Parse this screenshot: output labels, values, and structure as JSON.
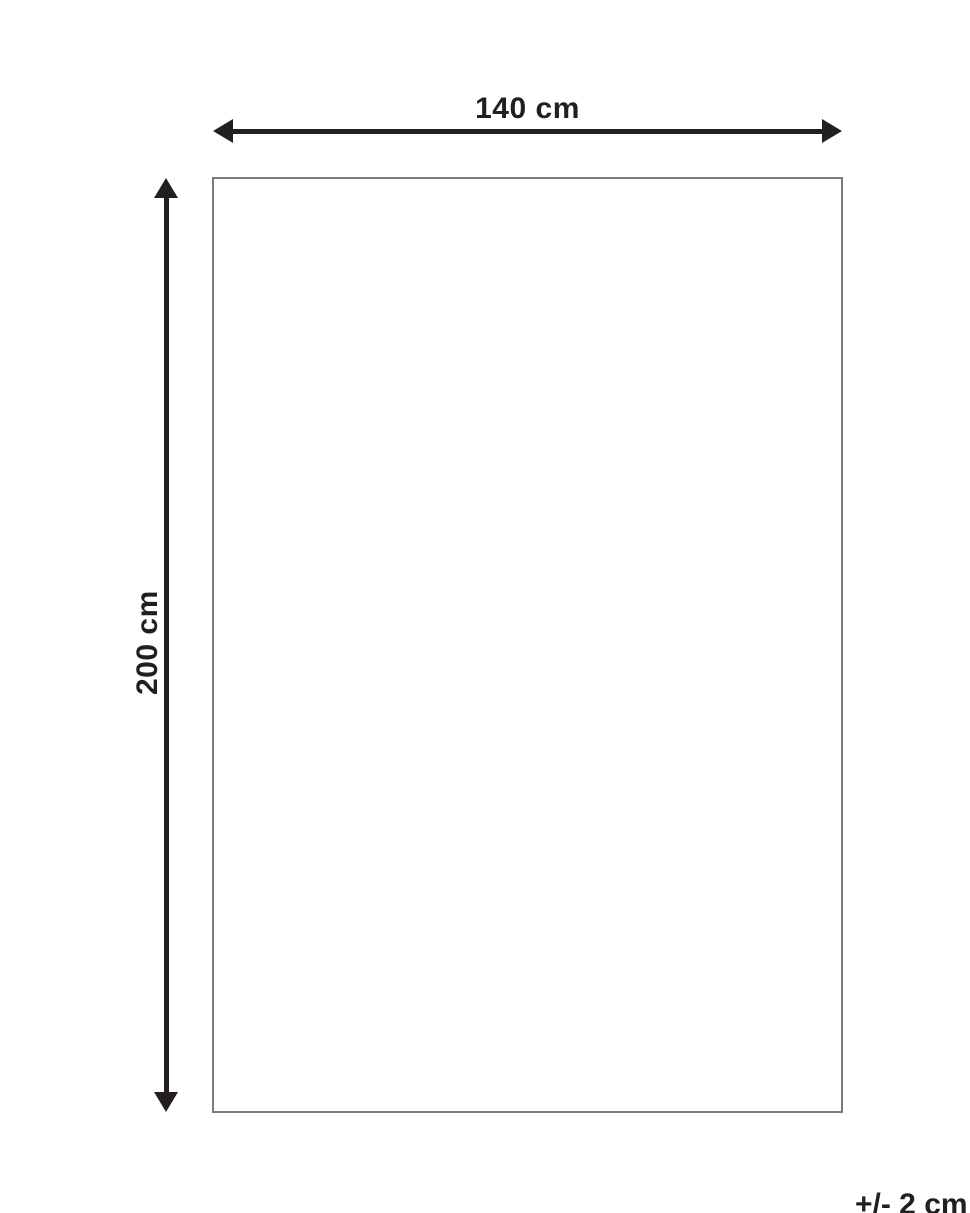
{
  "diagram": {
    "width_label": "140 cm",
    "height_label": "200 cm",
    "tolerance_label": "+/- 2 cm"
  },
  "icons": {
    "horizontal_arrow": "double-headed-arrow-horizontal",
    "vertical_arrow": "double-headed-arrow-vertical"
  },
  "colors": {
    "background": "#ffffff",
    "line": "#231f20",
    "text": "#231f20",
    "rect_border": "#7b7b7b"
  }
}
